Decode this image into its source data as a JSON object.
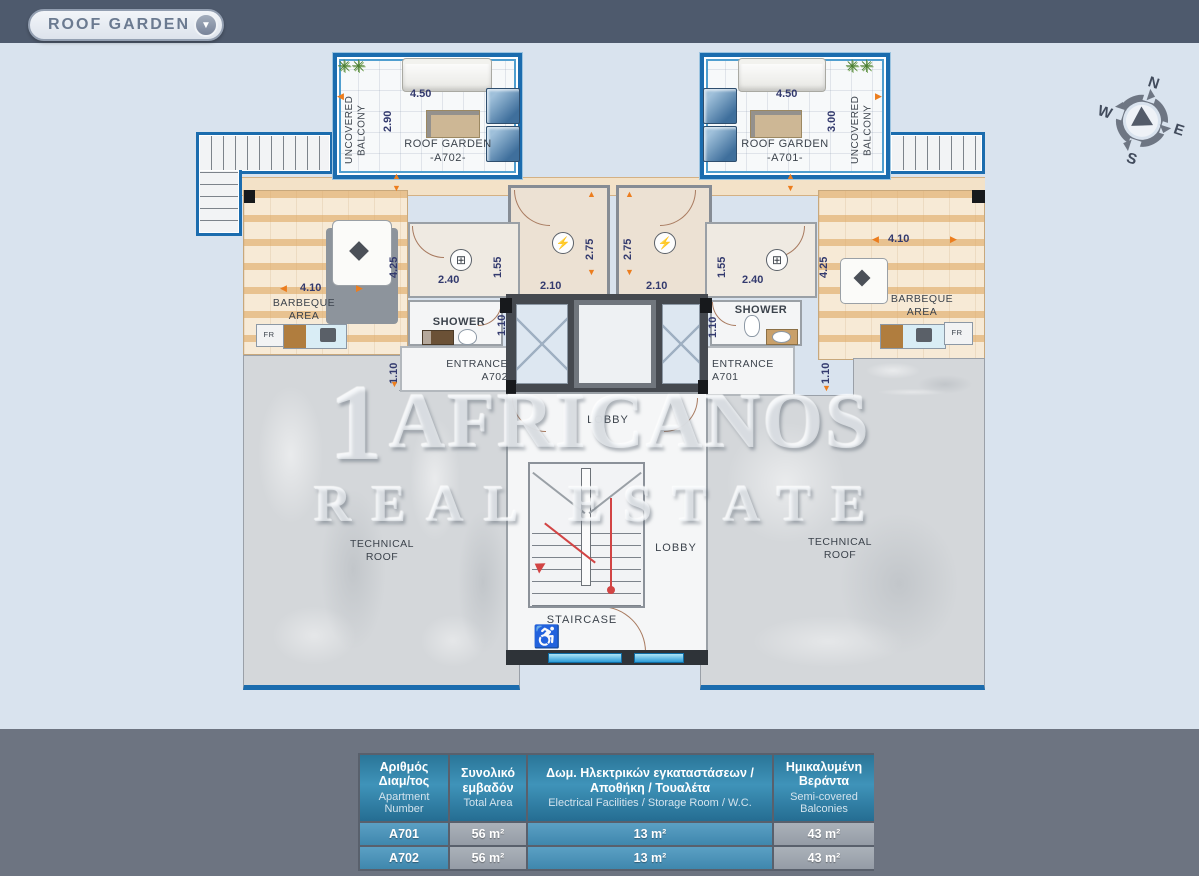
{
  "topbar": {
    "title": "ROOF GARDEN",
    "chevron": "▼"
  },
  "compass": {
    "n": "N",
    "e": "E",
    "s": "S",
    "w": "W"
  },
  "watermark": {
    "numeral": "1",
    "line1": "AFRICANOS",
    "line2": "REAL ESTATE"
  },
  "plan": {
    "left": {
      "balcony": "UNCOVERED BALCONY",
      "garden1": "ROOF GARDEN",
      "garden2": "-A702-",
      "bbq1": "BARBEQUE",
      "bbq2": "AREA",
      "shower": "SHOWER",
      "entrance1": "ENTRANCE",
      "entrance2": "A702",
      "tech1": "TECHNICAL",
      "tech2": "ROOF",
      "fr": "FR"
    },
    "right": {
      "balcony": "UNCOVERED BALCONY",
      "garden1": "ROOF GARDEN",
      "garden2": "-A701-",
      "bbq1": "BARBEQUE",
      "bbq2": "AREA",
      "shower": "SHOWER",
      "entrance1": "ENTRANCE",
      "entrance2": "A701",
      "tech1": "TECHNICAL",
      "tech2": "ROOF",
      "fr": "FR"
    },
    "center": {
      "lobby_upper": "LOBBY",
      "lobby_lower": "LOBBY",
      "staircase": "STAIRCASE"
    },
    "dims": {
      "d450": "4.50",
      "d290": "2.90",
      "d300": "3.00",
      "d425": "4.25",
      "d410": "4.10",
      "d240": "2.40",
      "d155": "1.55",
      "d110": "1.10",
      "d275": "2.75",
      "d210": "2.10"
    },
    "icons": {
      "up": "▲",
      "down": "▼",
      "left": "◀",
      "right": "▶",
      "electric": "⚡",
      "vent": "⊞",
      "wheelchair": "♿",
      "plant": "✳✳"
    }
  },
  "table": {
    "columns": [
      {
        "el": "Αριθμός Διαμ/τος",
        "en": "Apartment Number"
      },
      {
        "el": "Συνολικό εμβαδόν",
        "en": "Total Area"
      },
      {
        "el": "Δωμ. Ηλεκτρικών εγκαταστάσεων / Αποθήκη / Τουαλέτα",
        "en": "Electrical Facilities / Storage Room / W.C."
      },
      {
        "el": "Ημικαλυμένη Βεράντα",
        "en": "Semi-covered Balconies"
      }
    ],
    "rows": [
      {
        "apt": "A701",
        "total": "56 m²",
        "elec": "13 m²",
        "semi": "43 m²"
      },
      {
        "apt": "A702",
        "total": "56 m²",
        "elec": "13 m²",
        "semi": "43 m²"
      }
    ]
  },
  "colors": {
    "topbar": "#4e5a6d",
    "canvas": "#d9e3ee",
    "bottom_band": "#6d7481",
    "wall_blue": "#1b6cae",
    "pergola": "#f3e2c8",
    "table_header": "#2f7fa3",
    "table_blue": "#4a90b8",
    "table_gray": "#9aa3ad",
    "dim_text": "#333a6e",
    "arrow_orange": "#ec7d1e"
  }
}
